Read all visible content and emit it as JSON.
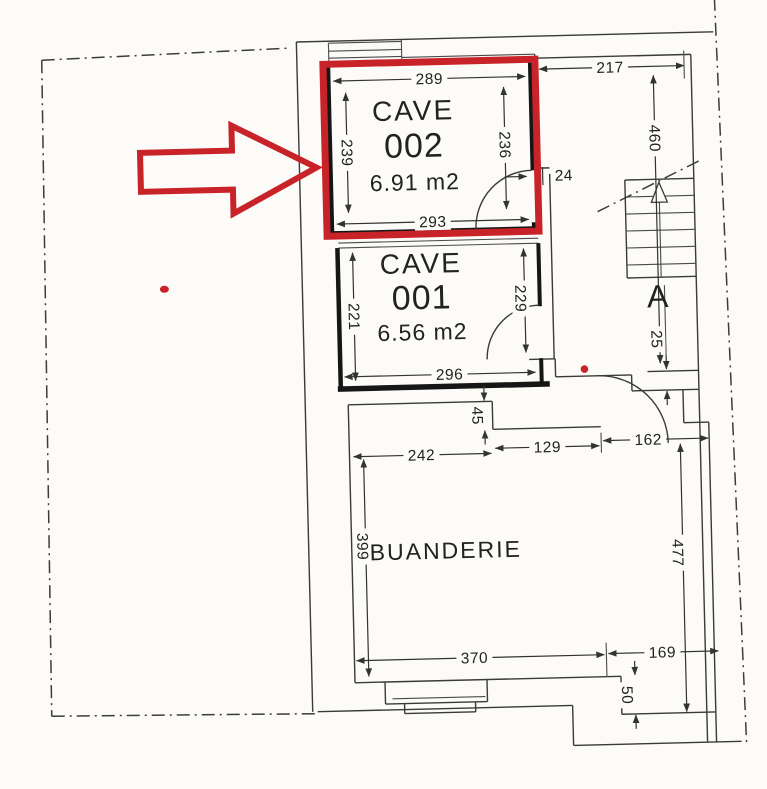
{
  "plan_title": "basement-floor-plan",
  "rooms": {
    "cave002": {
      "name": "CAVE",
      "number": "002",
      "area": "6.91 m2"
    },
    "cave001": {
      "name": "CAVE",
      "number": "001",
      "area": "6.56 m2"
    },
    "buanderie": {
      "name": "BUANDERIE"
    }
  },
  "section_marker": "A",
  "dims": {
    "cave002_top": "289",
    "cave002_left": "239",
    "cave002_right": "236",
    "cave002_bottom": "293",
    "cave001_left": "221",
    "cave001_right": "229",
    "cave001_bottom": "296",
    "top_wall": "217",
    "stairwell": "460",
    "wall_24": "24",
    "wall_25": "25",
    "niche_45": "45",
    "hall_242": "242",
    "hall_129": "129",
    "hall_162": "162",
    "buanderie_left": "399",
    "buanderie_bottom": "370",
    "corridor_right": "477",
    "bottom_right": "169",
    "step_50": "50"
  },
  "colors": {
    "highlight": "#c9232a",
    "ink": "#3a3a3a",
    "paper": "#fcfbf8"
  }
}
